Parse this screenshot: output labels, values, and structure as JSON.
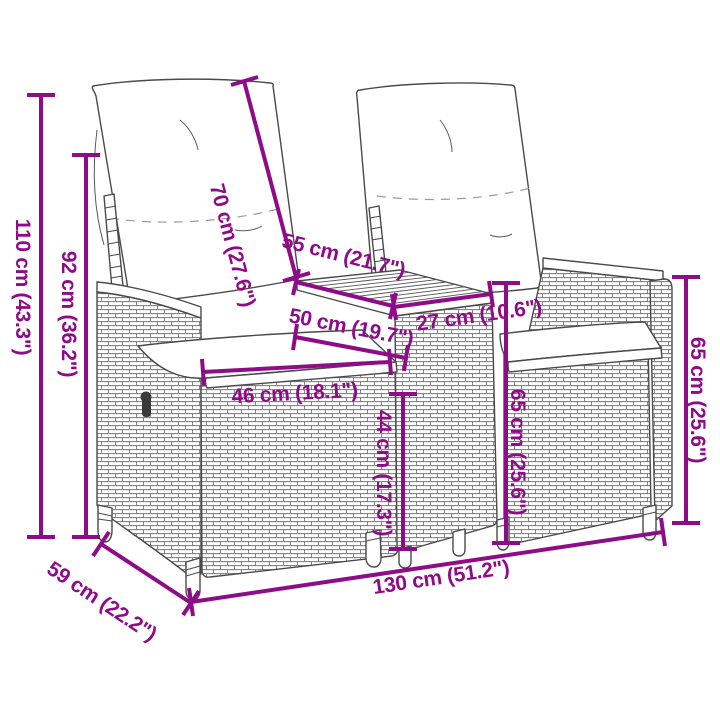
{
  "figure": {
    "name": "garden-sofa-dimension-diagram",
    "subject": "2-seater reclining patio sofa set with middle tea table, line-art with measurements",
    "accent_color": "#8E0C87",
    "line_art_color": "#4a4a4a",
    "background_color": "#ffffff"
  },
  "dimensions": {
    "overall_height": {
      "cm": 110,
      "inch": 43.3,
      "label": "110 cm (43.3\")"
    },
    "back_height": {
      "cm": 92,
      "inch": 36.2,
      "label": "92 cm (36.2\")"
    },
    "backrest_length": {
      "cm": 70,
      "inch": 27.6,
      "label": "70 cm (27.6\")"
    },
    "table_depth": {
      "cm": 55,
      "inch": 21.7,
      "label": "55 cm (21.7\")"
    },
    "seat_depth": {
      "cm": 50,
      "inch": 19.7,
      "label": "50 cm (19.7\")"
    },
    "table_width": {
      "cm": 27,
      "inch": 10.6,
      "label": "27 cm (10.6\")"
    },
    "seat_width": {
      "cm": 46,
      "inch": 18.1,
      "label": "46 cm (18.1\")"
    },
    "seat_height": {
      "cm": 44,
      "inch": 17.3,
      "label": "44 cm (17.3\")"
    },
    "table_height": {
      "cm": 65,
      "inch": 25.6,
      "label": "65 cm (25.6\")"
    },
    "armrest_height": {
      "cm": 65,
      "inch": 25.6,
      "label": "65 cm (25.6\")"
    },
    "overall_width": {
      "cm": 130,
      "inch": 51.2,
      "label": "130 cm (51.2\")"
    },
    "overall_depth": {
      "cm": 59,
      "inch": 22.2,
      "label": "59 cm (22.2\")"
    }
  }
}
